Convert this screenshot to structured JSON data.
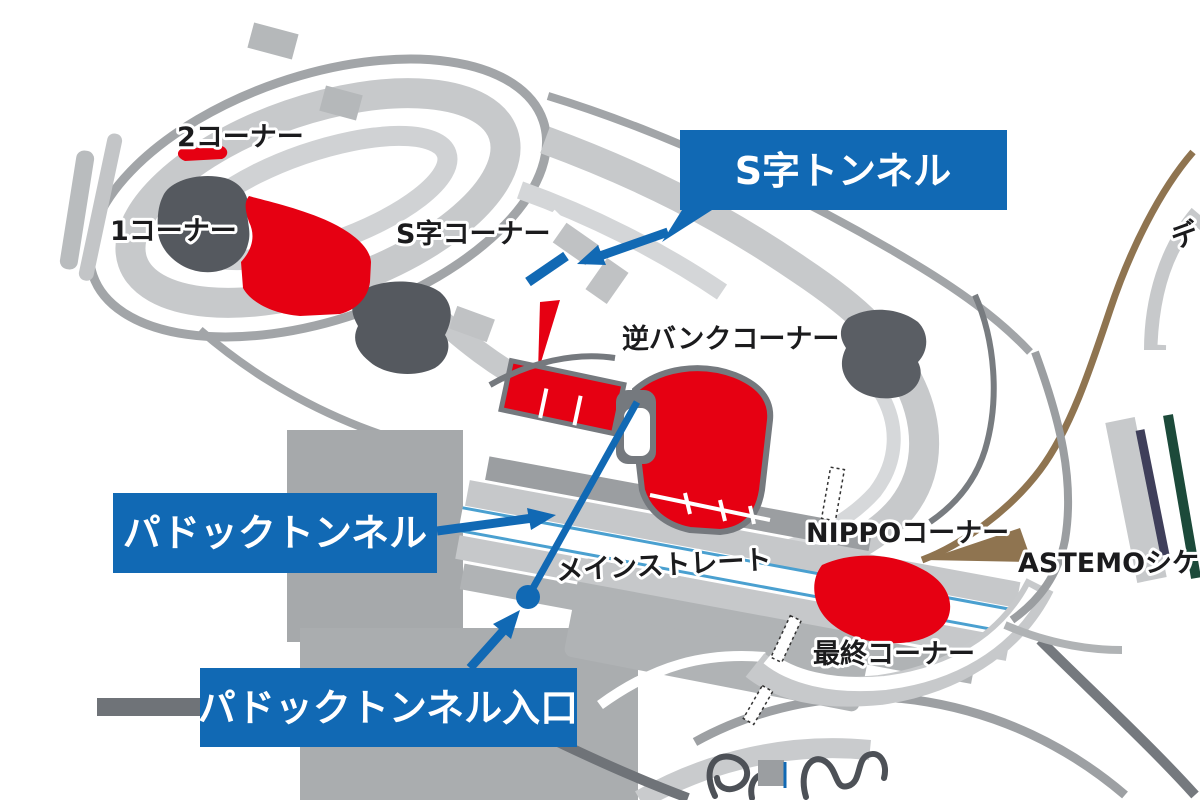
{
  "map": {
    "title": "circuit-map",
    "corner_labels": {
      "corner2": "2コーナー",
      "corner1": "1コーナー",
      "s_curves": "S字コーナー",
      "reverse_bank": "逆バンクコーナー",
      "main_straight": "メインストレート",
      "nippo": "NIPPOコーナー",
      "final_corner": "最終コーナー",
      "astemo_chicane": "ASTEMOシケ",
      "degner": "デ"
    },
    "callouts": {
      "s_tunnel": "S字トンネル",
      "paddock_tunnel": "パドックトンネル",
      "paddock_tunnel_entrance": "パドックトンネル入口"
    },
    "colors": {
      "callout_blue": "#1169b4",
      "highlight_red": "#e60012",
      "track_band_light": "#c7c9cb",
      "track_band_lighter": "#d4d6d8",
      "road_gray": "#a2a5a8",
      "road_dark": "#75797e",
      "structure_dark": "#55595f",
      "parking_gray": "#aaadaf",
      "bridge_brown": "#8f7450",
      "stripe_navy": "#3f3f5a",
      "stripe_green": "#1c4a3a",
      "track_edge_blue": "#4aa0d0"
    }
  }
}
